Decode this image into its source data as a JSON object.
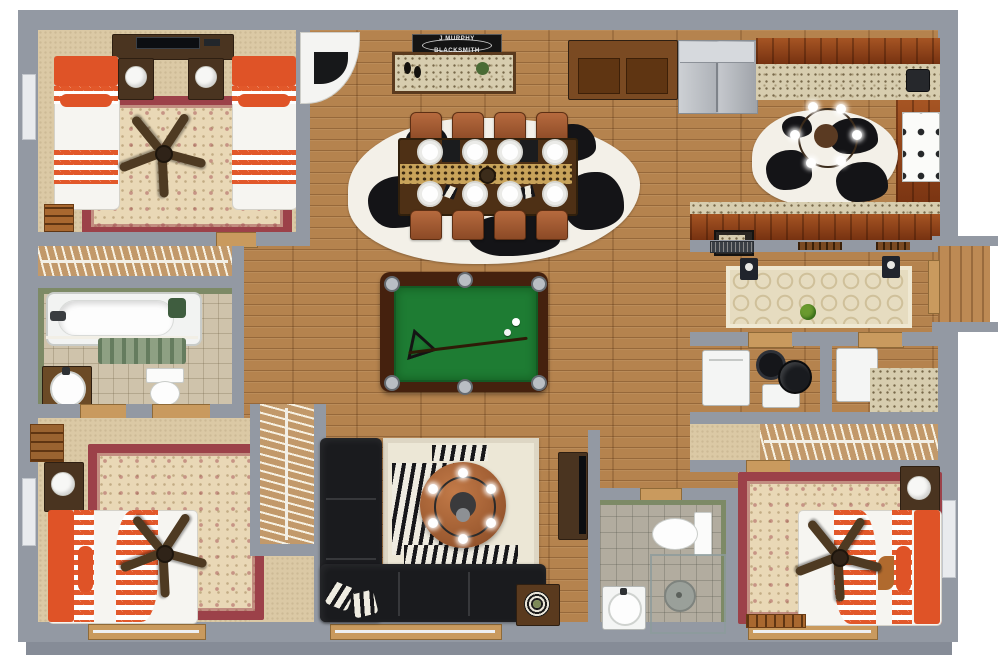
{
  "scene": {
    "type": "3d-floorplan-top-view",
    "background": "#ffffff",
    "sign": {
      "line1": "J MURPHY",
      "line2": "BLACKSMITH"
    },
    "palette": {
      "wall": "#9399a3",
      "wood_floor": "#b5834e",
      "carpet": "#dbc9a5",
      "rug_border_red": "#9c4149",
      "rug_cream": "#e9d8b6",
      "accent_orange": "#df5327",
      "pool_felt_green": "#1e7c33",
      "cabinet_cherry": "#8d3d17",
      "granite": "#d7cdaf",
      "sofa_black": "#1a1b1e",
      "sage_green": "#7d8a66",
      "leather_chair": "#a85c36",
      "ottoman_leather": "#b06a3e",
      "stainless": "#c0c4c9"
    },
    "rooms": [
      {
        "name": "bedroom-top-left",
        "furniture": [
          "twin-bed",
          "twin-bed",
          "nightstand-lamp",
          "nightstand-lamp",
          "dresser-tv",
          "ceiling-fan",
          "oriental-rug",
          "closet-hangers",
          "blanket-ladder"
        ]
      },
      {
        "name": "bathroom-left",
        "furniture": [
          "bathtub",
          "shower-curtain",
          "vanity-sink",
          "toilet",
          "green-towel"
        ]
      },
      {
        "name": "bedroom-bottom-left",
        "furniture": [
          "queen-bed",
          "nightstand-lamp",
          "ceiling-fan",
          "oriental-rug",
          "closet-hangers",
          "wall-shelf"
        ]
      },
      {
        "name": "dining-room",
        "furniture": [
          "dining-table",
          "dining-chairs-x8",
          "dinner-plates-x8",
          "leopard-runner",
          "cowhide-rug",
          "buffet-console",
          "wine-bottles",
          "corner-fireplace",
          "blacksmith-sign",
          "wood-hutch"
        ]
      },
      {
        "name": "kitchen",
        "furniture": [
          "refrigerator",
          "upper-cabinets",
          "granite-counter",
          "range-stove",
          "coffee-maker",
          "cowhide-rug",
          "ceiling-light",
          "peninsula-counter",
          "menu-board"
        ]
      },
      {
        "name": "game-area",
        "furniture": [
          "pool-table",
          "cue-stick",
          "triangle-rack",
          "billiard-balls"
        ]
      },
      {
        "name": "living-room",
        "furniture": [
          "sectional-sofa",
          "zebra-pillows",
          "zebra-rug",
          "round-leather-ottoman",
          "chandelier",
          "side-table-plate",
          "media-console-tv"
        ]
      },
      {
        "name": "hallway",
        "furniture": [
          "trellis-runner-rug",
          "wall-sconce",
          "wall-sconce",
          "plant",
          "air-vent",
          "coat-hooks"
        ]
      },
      {
        "name": "utility-room",
        "furniture": [
          "washer",
          "storage-box",
          "water-heater",
          "vacuum"
        ]
      },
      {
        "name": "laundry-room",
        "furniture": [
          "appliance",
          "granite-folding-counter"
        ]
      },
      {
        "name": "bathroom-bottom",
        "furniture": [
          "toilet",
          "walk-in-shower",
          "round-sink"
        ]
      },
      {
        "name": "bedroom-bottom-right",
        "furniture": [
          "queen-bed",
          "nightstand-lamp",
          "ceiling-fan",
          "oriental-rug",
          "closet-hangers",
          "foot-bench"
        ]
      },
      {
        "name": "entry",
        "furniture": [
          "entry-alcove",
          "door-threshold"
        ]
      }
    ]
  }
}
